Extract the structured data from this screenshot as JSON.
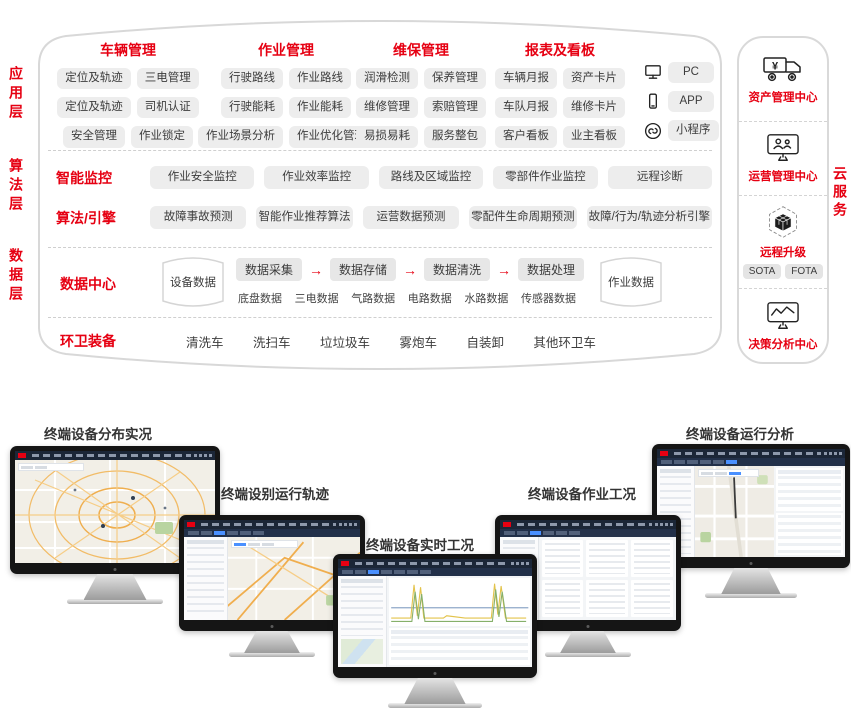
{
  "colors": {
    "accent_red": "#e60012",
    "pill_bg": "#ededed",
    "dark_header": "#1b2637",
    "highlight_blue": "#4a90ff"
  },
  "left_labels": [
    "应用层",
    "算法层",
    "数据层"
  ],
  "cloud_label": "云服务",
  "app": {
    "groups": [
      {
        "title": "车辆管理",
        "pills": [
          "定位及轨迹",
          "三电管理",
          "定位及轨迹",
          "司机认证",
          "安全管理",
          "作业锁定"
        ]
      },
      {
        "title": "作业管理",
        "pills": [
          "行驶路线",
          "作业路线",
          "行驶能耗",
          "作业能耗",
          "作业场景分析",
          "作业优化管理"
        ]
      },
      {
        "title": "维保管理",
        "pills": [
          "润滑检测",
          "保养管理",
          "维修管理",
          "索赔管理",
          "易损易耗",
          "服务整包"
        ]
      },
      {
        "title": "报表及看板",
        "pills": [
          "车辆月报",
          "资产卡片",
          "车队月报",
          "维修卡片",
          "客户看板",
          "业主看板"
        ]
      }
    ],
    "devices": [
      {
        "icon": "pc-icon",
        "label": "PC"
      },
      {
        "icon": "phone-icon",
        "label": "APP"
      },
      {
        "icon": "miniprogram-link-icon",
        "label": "小程序"
      }
    ]
  },
  "algo": {
    "rows": [
      {
        "title": "智能监控",
        "pills": [
          "作业安全监控",
          "作业效率监控",
          "路线及区域监控",
          "零部件作业监控",
          "远程诊断"
        ]
      },
      {
        "title": "算法/引擎",
        "pills": [
          "故障事故预测",
          "智能作业推荐算法",
          "运营数据预测",
          "零配件生命周期预测",
          "故障/行为/轨迹分析引擎"
        ]
      }
    ]
  },
  "data_layer": {
    "title": "数据中心",
    "device_db": "设备数据",
    "job_db": "作业数据",
    "flow": [
      "数据采集",
      "数据存储",
      "数据清洗",
      "数据处理"
    ],
    "arrow": "→",
    "sources": [
      "底盘数据",
      "三电数据",
      "气路数据",
      "电路数据",
      "水路数据",
      "传感器数据"
    ],
    "equip_title": "环卫装备",
    "equipment": [
      "清洗车",
      "洗扫车",
      "垃垃圾车",
      "雾炮车",
      "自装卸",
      "其他环卫车"
    ]
  },
  "cloud": {
    "sections": [
      {
        "icon": "truck-yuan-icon",
        "label": "资产管理中心"
      },
      {
        "icon": "monitor-users-icon",
        "label": "运营管理中心"
      },
      {
        "icon": "cube-ota-icon",
        "label": "远程升级",
        "pills": [
          "SOTA",
          "FOTA"
        ]
      },
      {
        "icon": "monitor-chart-icon",
        "label": "决策分析中心"
      }
    ]
  },
  "monitors": [
    {
      "label": "终端设备分布实况"
    },
    {
      "label": "终端设别运行轨迹"
    },
    {
      "label": "终端设备实时工况"
    },
    {
      "label": "终端设备作业工况"
    },
    {
      "label": "终端设备运行分析"
    }
  ]
}
